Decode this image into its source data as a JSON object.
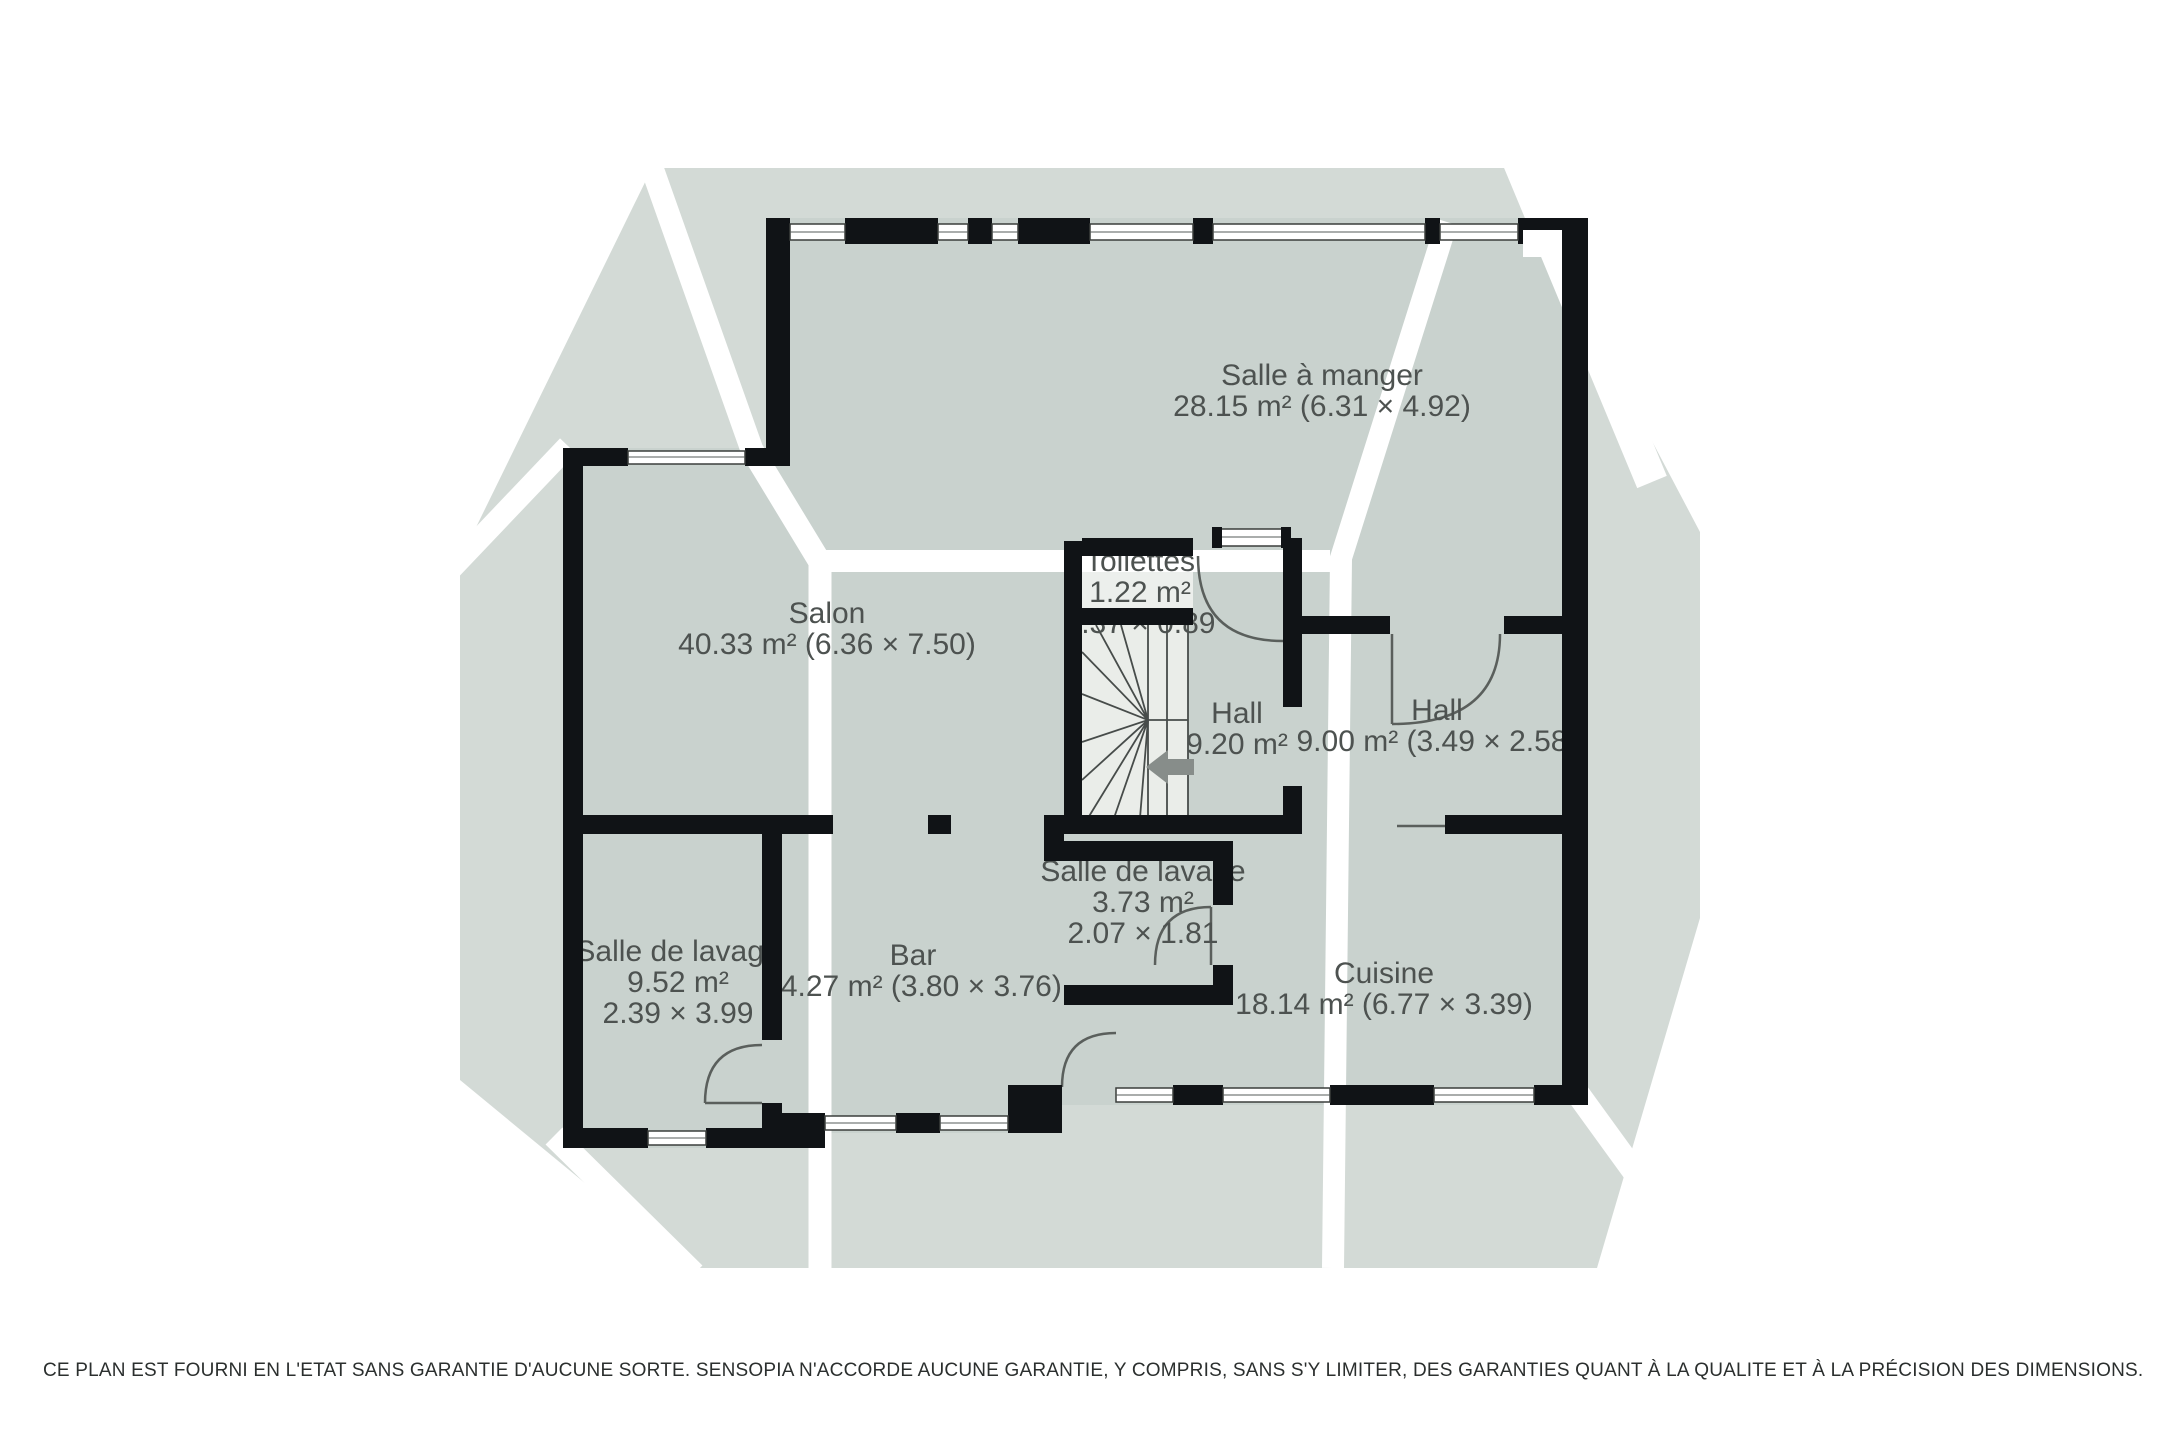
{
  "rooms": {
    "dining": {
      "name": "Salle à manger",
      "area": "28.15 m² (6.31 × 4.92)"
    },
    "salon": {
      "name": "Salon",
      "area": "40.33 m² (6.36 × 7.50)"
    },
    "toilettes": {
      "name": "Toilettes",
      "area": "1.22 m²",
      "dims": "1.37 × 0.89"
    },
    "hall_stairs": {
      "name": "Hall",
      "area": "9.20 m²"
    },
    "hall_right": {
      "name": "Hall",
      "area": "9.00 m² (3.49 × 2.58)"
    },
    "laundry_small": {
      "name": "Salle de lavage",
      "area": "3.73 m²",
      "dims": "2.07 × 1.81"
    },
    "laundry_left": {
      "name": "Salle de lavage",
      "area": "9.52 m²",
      "dims": "2.39 × 3.99"
    },
    "bar": {
      "name": "Bar",
      "area": "14.27 m² (3.80 × 3.76)"
    },
    "cuisine": {
      "name": "Cuisine",
      "area": "18.14 m² (6.77 × 3.39)"
    }
  },
  "footer": {
    "disclaimer": "CE PLAN EST FOURNI EN L'ETAT SANS GARANTIE D'AUCUNE SORTE. SENSOPIA N'ACCORDE AUCUNE GARANTIE, Y COMPRIS, SANS S'Y LIMITER, DES GARANTIES QUANT À LA QUALITE ET À LA PRÉCISION DES DIMENSIONS."
  },
  "colors": {
    "backdrop": "#d3dad6",
    "interior": "#c9d2ce",
    "stair_fill": "#eaede9",
    "stripe": "#ffffff",
    "wall": "#101316",
    "label_text": "#4d5250",
    "arrow": "#878d8a"
  }
}
